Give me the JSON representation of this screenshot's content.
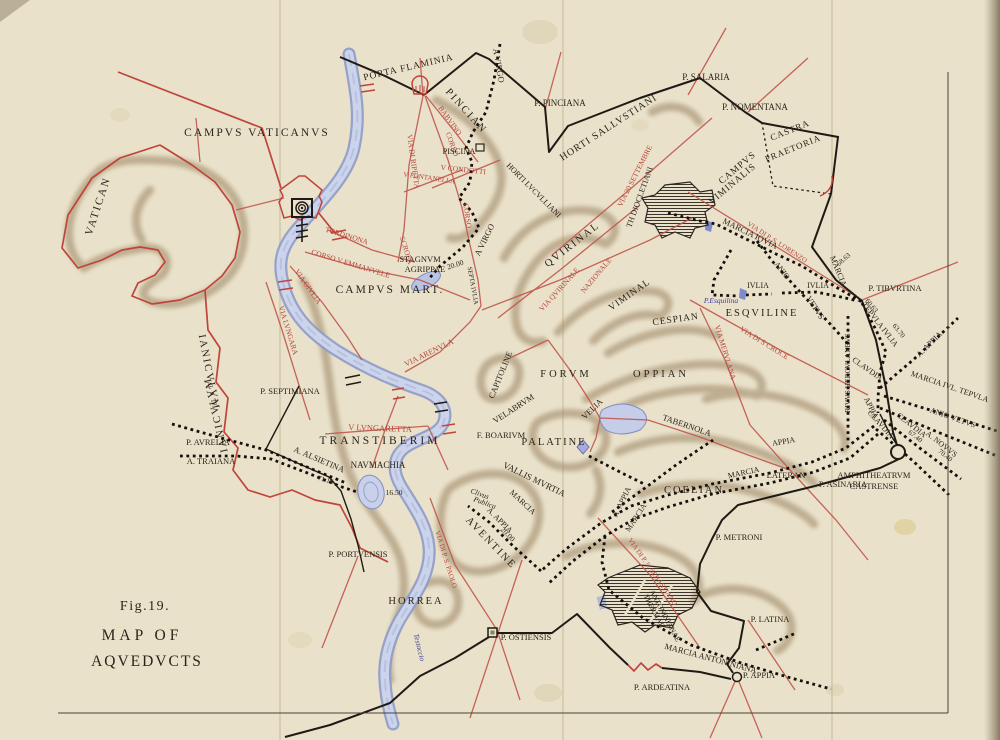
{
  "figure": {
    "fig_label": "Fig.19.",
    "title_line1": "MAP OF",
    "title_line2": "AQVEDVCTS"
  },
  "colors": {
    "paper": "#e9e1ca",
    "paper_dark": "#d8cdab",
    "ink": "#2b241a",
    "wall_black": "#1f1a14",
    "road_red": "#b5473b",
    "wall_red": "#c0443a",
    "water_fill": "#ccd4ec",
    "water_edge": "#8d9bc8",
    "hill_brown": "#9a8161",
    "blue_text": "#42429a",
    "hatch_dark": "#3a352c"
  },
  "map": {
    "labels": [
      {
        "t": "CAMPVS VATICANVS",
        "x": 257,
        "y": 136,
        "r": 0,
        "s": 11.5,
        "ls": 2
      },
      {
        "t": "VATICAN",
        "x": 101,
        "y": 207,
        "r": -72,
        "s": 11,
        "ls": 2
      },
      {
        "t": "PORTA FLAMINIA",
        "x": 409,
        "y": 70,
        "r": -13,
        "s": 9.5,
        "ls": 1
      },
      {
        "t": "PINCIAN",
        "x": 464,
        "y": 113,
        "r": 48,
        "s": 10.5,
        "ls": 2
      },
      {
        "t": "A VIRGO",
        "x": 496,
        "y": 66,
        "r": 80,
        "s": 8.5
      },
      {
        "t": "P. PINCIANA",
        "x": 560,
        "y": 106,
        "r": 0,
        "s": 9
      },
      {
        "t": "HORTI SALLVSTIANI",
        "x": 610,
        "y": 130,
        "r": -33,
        "s": 10,
        "ls": 1
      },
      {
        "t": "P. SALARIA",
        "x": 706,
        "y": 80,
        "r": 0,
        "s": 9
      },
      {
        "t": "P. NOMENTANA",
        "x": 755,
        "y": 110,
        "r": 0,
        "s": 9
      },
      {
        "t": "CASTRA",
        "x": 791,
        "y": 133,
        "r": -22,
        "s": 9,
        "ls": 1
      },
      {
        "t": "PRAETORIA",
        "x": 794,
        "y": 151,
        "r": -22,
        "s": 9,
        "ls": 1
      },
      {
        "t": "CAMPVS",
        "x": 739,
        "y": 170,
        "r": -40,
        "s": 9.5,
        "ls": 1
      },
      {
        "t": "VIMINALIS",
        "x": 734,
        "y": 186,
        "r": -40,
        "s": 9.5,
        "ls": 1
      },
      {
        "t": "VIA 20 SETTEMBRE",
        "x": 637,
        "y": 177,
        "r": -63,
        "s": 7.5,
        "c": "red"
      },
      {
        "t": "TH DIOCLETIANI",
        "x": 642,
        "y": 198,
        "r": -70,
        "s": 8
      },
      {
        "t": "BABVINO",
        "x": 448,
        "y": 122,
        "r": 54,
        "s": 7.5,
        "c": "red"
      },
      {
        "t": "CORSO",
        "x": 450,
        "y": 145,
        "r": 70,
        "s": 7.5,
        "c": "red"
      },
      {
        "t": "PISCINA",
        "x": 459,
        "y": 154,
        "r": 0,
        "s": 8.5
      },
      {
        "t": "V CONDOTTI",
        "x": 463,
        "y": 172,
        "r": 6,
        "s": 7.5,
        "c": "red"
      },
      {
        "t": "V FONTANELLA",
        "x": 429,
        "y": 180,
        "r": 8,
        "s": 7,
        "c": "red"
      },
      {
        "t": "VIA DI RIPETTA",
        "x": 411,
        "y": 162,
        "r": 82,
        "s": 7.5,
        "c": "red"
      },
      {
        "t": "CORSO",
        "x": 465,
        "y": 216,
        "r": 82,
        "s": 7.5,
        "c": "red"
      },
      {
        "t": "SCROFA",
        "x": 404,
        "y": 251,
        "r": 72,
        "s": 7.5,
        "c": "red"
      },
      {
        "t": "HORTI LVCVLLIANI",
        "x": 532,
        "y": 192,
        "r": 45,
        "s": 8
      },
      {
        "t": "STAGNVM",
        "x": 420,
        "y": 262,
        "r": 0,
        "s": 8.5
      },
      {
        "t": "AGRIPPAE",
        "x": 425,
        "y": 272,
        "r": 0,
        "s": 8.5
      },
      {
        "t": "20.00",
        "x": 456,
        "y": 267,
        "r": -18,
        "s": 7.5
      },
      {
        "t": "A VIRGO",
        "x": 487,
        "y": 241,
        "r": -64,
        "s": 8.5
      },
      {
        "t": "SEPTA IVLIA",
        "x": 471,
        "y": 286,
        "r": 80,
        "s": 6.5
      },
      {
        "t": "CAMPVS MART.",
        "x": 390,
        "y": 293,
        "r": 0,
        "s": 11.5,
        "ls": 2
      },
      {
        "t": "TORDINONA",
        "x": 346,
        "y": 238,
        "r": 17,
        "s": 7.5,
        "c": "red"
      },
      {
        "t": "CORSO V EMMANVELE",
        "x": 350,
        "y": 266,
        "r": 17,
        "s": 7.5,
        "c": "red"
      },
      {
        "t": "VIA GIVLIA",
        "x": 306,
        "y": 288,
        "r": 55,
        "s": 7.5,
        "c": "red"
      },
      {
        "t": "VIA LVNGARA",
        "x": 286,
        "y": 331,
        "r": 73,
        "s": 7.5,
        "c": "red"
      },
      {
        "t": "IANICVLVM",
        "x": 206,
        "y": 373,
        "r": 79,
        "s": 10.5,
        "ls": 2
      },
      {
        "t": "IANICVLVM",
        "x": 219,
        "y": 414,
        "r": 257,
        "s": 10.5,
        "ls": 2
      },
      {
        "t": "P. SEPTIMIANA",
        "x": 290,
        "y": 394,
        "r": 0,
        "s": 8.5
      },
      {
        "t": "V LVNGARETTA",
        "x": 380,
        "y": 431,
        "r": 2,
        "s": 8.5,
        "c": "red"
      },
      {
        "t": "TRANSTIBERIM",
        "x": 380,
        "y": 444,
        "r": 0,
        "s": 11.5,
        "ls": 3
      },
      {
        "t": "P. AVRELIA",
        "x": 208,
        "y": 445,
        "r": 0,
        "s": 8.5
      },
      {
        "t": "A. TRAIANA",
        "x": 211,
        "y": 464,
        "r": 0,
        "s": 8.5
      },
      {
        "t": "A. ALSIETINA",
        "x": 318,
        "y": 462,
        "r": 23,
        "s": 8.5
      },
      {
        "t": "71.16",
        "x": 325,
        "y": 482,
        "r": 16,
        "s": 7
      },
      {
        "t": "NAVMACHIA",
        "x": 378,
        "y": 468,
        "r": 0,
        "s": 9
      },
      {
        "t": "16.50",
        "x": 394,
        "y": 495,
        "r": 0,
        "s": 7.5
      },
      {
        "t": "P. PORTVENSIS",
        "x": 358,
        "y": 557,
        "r": 0,
        "s": 8.5
      },
      {
        "t": "VIA ARENVLA",
        "x": 430,
        "y": 355,
        "r": -26,
        "s": 8,
        "c": "red"
      },
      {
        "t": "CAPITOLINE",
        "x": 503,
        "y": 376,
        "r": -68,
        "s": 8.5
      },
      {
        "t": "FORVM",
        "x": 566,
        "y": 377,
        "r": 0,
        "s": 10.5,
        "ls": 3
      },
      {
        "t": "VELABRVM",
        "x": 515,
        "y": 411,
        "r": -33,
        "s": 8.5
      },
      {
        "t": "F. BOARIVM",
        "x": 501,
        "y": 438,
        "r": 0,
        "s": 8.5
      },
      {
        "t": "PALATINE",
        "x": 554,
        "y": 445,
        "r": 0,
        "s": 10.5,
        "ls": 2
      },
      {
        "t": "VELIA",
        "x": 594,
        "y": 411,
        "r": -44,
        "s": 8.5
      },
      {
        "t": "VALLIS MVRTIA",
        "x": 533,
        "y": 482,
        "r": 26,
        "s": 9
      },
      {
        "t": "MARCIA",
        "x": 521,
        "y": 504,
        "r": 43,
        "s": 8
      },
      {
        "t": "Clivus",
        "x": 479,
        "y": 496,
        "r": 20,
        "s": 7.5,
        "i": true
      },
      {
        "t": "Publica",
        "x": 484,
        "y": 505,
        "r": 20,
        "s": 7.5,
        "i": true
      },
      {
        "t": "A. APPIA",
        "x": 498,
        "y": 522,
        "r": 45,
        "s": 8
      },
      {
        "t": "20.00",
        "x": 506,
        "y": 536,
        "r": 45,
        "s": 7.5
      },
      {
        "t": "AVENTINE",
        "x": 489,
        "y": 545,
        "r": 46,
        "s": 10.5,
        "ls": 2
      },
      {
        "t": "VIA DI P. S. PAOLO",
        "x": 444,
        "y": 560,
        "r": 73,
        "s": 7,
        "c": "red"
      },
      {
        "t": "HORREA",
        "x": 416,
        "y": 604,
        "r": 0,
        "s": 10.5,
        "ls": 2
      },
      {
        "t": "Testaccio",
        "x": 417,
        "y": 648,
        "r": 76,
        "s": 7.5,
        "c": "blue",
        "i": true
      },
      {
        "t": "P. OSTIENSIS",
        "x": 526,
        "y": 640,
        "r": 0,
        "s": 8.5
      },
      {
        "t": "COELIAN",
        "x": 694,
        "y": 493,
        "r": 0,
        "s": 10.5,
        "ls": 2
      },
      {
        "t": "A. APPIA",
        "x": 624,
        "y": 503,
        "r": -64,
        "s": 8
      },
      {
        "t": "MARCIA",
        "x": 638,
        "y": 519,
        "r": -57,
        "s": 8
      },
      {
        "t": "APPIA",
        "x": 784,
        "y": 444,
        "r": -10,
        "s": 8
      },
      {
        "t": "MARCIA",
        "x": 744,
        "y": 475,
        "r": -12,
        "s": 8
      },
      {
        "t": "LATERAN",
        "x": 786,
        "y": 478,
        "r": 0,
        "s": 8.5
      },
      {
        "t": "TABERNOLA",
        "x": 686,
        "y": 428,
        "r": 19,
        "s": 8.5
      },
      {
        "t": "VIA DI P. S. SEBASTIANO",
        "x": 651,
        "y": 573,
        "r": 55,
        "s": 7,
        "c": "red"
      },
      {
        "t": "THERMAE",
        "x": 652,
        "y": 612,
        "r": 62,
        "s": 7.5
      },
      {
        "t": "ANTONINIANAE",
        "x": 663,
        "y": 617,
        "r": 62,
        "s": 7.5
      },
      {
        "t": "MARCIA ANTONINIANA",
        "x": 710,
        "y": 661,
        "r": 15,
        "s": 8.5
      },
      {
        "t": "P. ARDEATINA",
        "x": 662,
        "y": 690,
        "r": 0,
        "s": 8.5
      },
      {
        "t": "P. APPIA",
        "x": 759,
        "y": 678,
        "r": 0,
        "s": 8.5
      },
      {
        "t": "P. LATINA",
        "x": 770,
        "y": 622,
        "r": 0,
        "s": 8.5
      },
      {
        "t": "P. METRONI",
        "x": 739,
        "y": 540,
        "r": 0,
        "s": 8.5
      },
      {
        "t": "P. ASINARIA",
        "x": 843,
        "y": 487,
        "r": 0,
        "s": 8.5
      },
      {
        "t": "AMPHITHEATRVM",
        "x": 874,
        "y": 478,
        "r": 0,
        "s": 8.5
      },
      {
        "t": "CASTRENSE",
        "x": 874,
        "y": 489,
        "r": 0,
        "s": 8.5
      },
      {
        "t": "ESQVILINE",
        "x": 762,
        "y": 316,
        "r": 0,
        "s": 10.5,
        "ls": 2
      },
      {
        "t": "P.Esquilina",
        "x": 721,
        "y": 303,
        "r": 0,
        "s": 7.5,
        "c": "blue",
        "i": true
      },
      {
        "t": "IVLIA",
        "x": 758,
        "y": 288,
        "r": 0,
        "s": 8
      },
      {
        "t": "IVLIA",
        "x": 818,
        "y": 288,
        "r": 0,
        "s": 8
      },
      {
        "t": "ANIO",
        "x": 780,
        "y": 272,
        "r": 52,
        "s": 8
      },
      {
        "t": "VETVS",
        "x": 813,
        "y": 309,
        "r": 57,
        "s": 8
      },
      {
        "t": "MARCIA IOVIA",
        "x": 749,
        "y": 236,
        "r": 26,
        "s": 8.5
      },
      {
        "t": "VIA DI P. S. LORENZO",
        "x": 776,
        "y": 244,
        "r": 33,
        "s": 7,
        "c": "red"
      },
      {
        "t": "MARCIA",
        "x": 836,
        "y": 272,
        "r": 68,
        "s": 8
      },
      {
        "t": "58.63",
        "x": 845,
        "y": 261,
        "r": -42,
        "s": 7
      },
      {
        "t": "P. TIBVRTINA",
        "x": 895,
        "y": 291,
        "r": 0,
        "s": 8.5
      },
      {
        "t": "60.63",
        "x": 870,
        "y": 307,
        "r": 50,
        "s": 7
      },
      {
        "t": "TEPVLA IVLIA",
        "x": 878,
        "y": 326,
        "r": 52,
        "s": 8
      },
      {
        "t": "63.70",
        "x": 897,
        "y": 332,
        "r": 52,
        "s": 7
      },
      {
        "t": "A. APPIA",
        "x": 931,
        "y": 346,
        "r": -45,
        "s": 8
      },
      {
        "t": "CLAVDIA",
        "x": 866,
        "y": 371,
        "r": 35,
        "s": 8
      },
      {
        "t": "MARCIA IVL. TEPVLA",
        "x": 949,
        "y": 389,
        "r": 19,
        "s": 8
      },
      {
        "t": "ANIO VETVS",
        "x": 952,
        "y": 420,
        "r": 19,
        "s": 8
      },
      {
        "t": "APPIA",
        "x": 869,
        "y": 409,
        "r": 63,
        "s": 8
      },
      {
        "t": "CLAVDIA",
        "x": 879,
        "y": 426,
        "r": 48,
        "s": 8
      },
      {
        "t": "CLAVDIA",
        "x": 910,
        "y": 427,
        "r": 38,
        "s": 8
      },
      {
        "t": "67.40",
        "x": 914,
        "y": 438,
        "r": 38,
        "s": 7
      },
      {
        "t": "A. NOVVS",
        "x": 940,
        "y": 446,
        "r": 38,
        "s": 8
      },
      {
        "t": "70.40",
        "x": 944,
        "y": 457,
        "r": 38,
        "s": 7
      },
      {
        "t": "RIVVS HERCVLANEVS",
        "x": 850,
        "y": 373,
        "r": -90,
        "s": 7.5
      },
      {
        "t": "QVIRINAL",
        "x": 574,
        "y": 247,
        "r": -38,
        "s": 10.5,
        "ls": 2
      },
      {
        "t": "VIA QVIRINALE",
        "x": 561,
        "y": 291,
        "r": -48,
        "s": 7.5,
        "c": "red"
      },
      {
        "t": "NAZIONALE",
        "x": 598,
        "y": 277,
        "r": -50,
        "s": 7.5,
        "c": "red"
      },
      {
        "t": "VIMINAL",
        "x": 631,
        "y": 297,
        "r": -35,
        "s": 9.5,
        "ls": 1
      },
      {
        "t": "CESPIAN",
        "x": 676,
        "y": 322,
        "r": -8,
        "s": 9.5,
        "ls": 1
      },
      {
        "t": "OPPIAN",
        "x": 661,
        "y": 377,
        "r": 0,
        "s": 10.5,
        "ls": 3
      },
      {
        "t": "VIA MERVLANA",
        "x": 723,
        "y": 353,
        "r": 73,
        "s": 7.5,
        "c": "red"
      },
      {
        "t": "VIA DI S CROCE",
        "x": 763,
        "y": 345,
        "r": 32,
        "s": 7.5,
        "c": "red"
      }
    ]
  }
}
